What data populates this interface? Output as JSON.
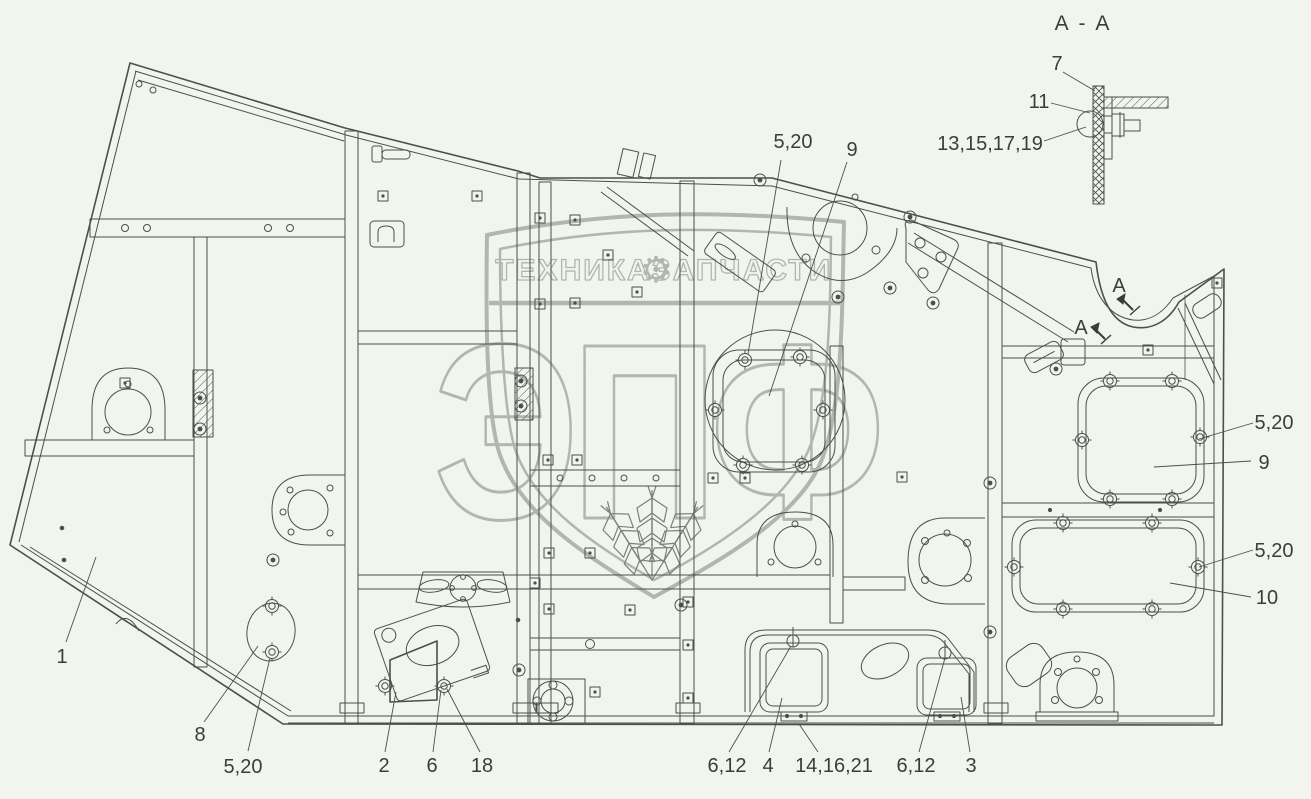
{
  "colors": {
    "background": "#f2f5ee",
    "line": "#4c4f4b",
    "label": "#3b3d3b",
    "watermark": "#b3b6ae",
    "wheat_ears": "#7d807a"
  },
  "watermark": {
    "word_left": "ТЕХНИКА",
    "gear_icon": "⚙",
    "word_right": "ЗАПЧАСТИ",
    "logo_text": "ЭПФ"
  },
  "section_view": {
    "title": "А - А",
    "callout_7": "7",
    "callout_11": "11",
    "callout_13_15_17_19": "13,15,17,19"
  },
  "section_arrows": {
    "upper": "А",
    "lower": "А"
  },
  "callouts": {
    "top_5_20": "5,20",
    "top_9": "9",
    "right_5_20_upper": "5,20",
    "right_9": "9",
    "right_5_20_lower": "5,20",
    "right_10": "10",
    "left_1": "1",
    "bottom_8": "8",
    "bottom_5_20": "5,20",
    "bottom_2": "2",
    "bottom_6": "6",
    "bottom_18": "18",
    "bottom_6_12_left": "6,12",
    "bottom_4": "4",
    "bottom_14_16_21": "14,16,21",
    "bottom_6_12_right": "6,12",
    "bottom_3": "3"
  }
}
